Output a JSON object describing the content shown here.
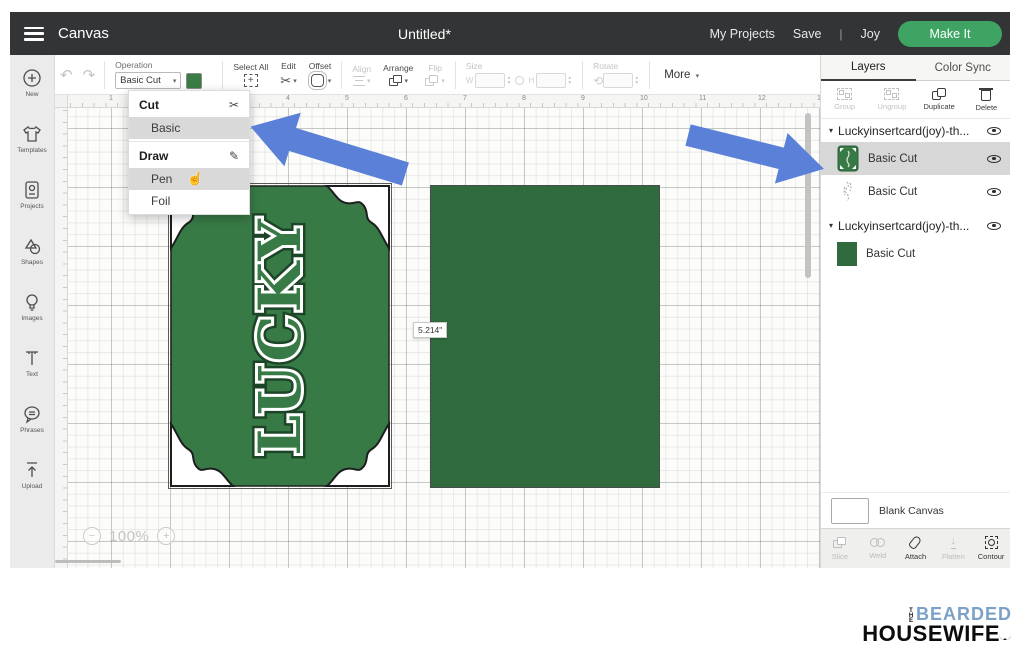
{
  "topbar": {
    "app_title": "Canvas",
    "doc_title": "Untitled*",
    "my_projects": "My Projects",
    "save": "Save",
    "pipe": "|",
    "machine": "Joy",
    "make_it": "Make It"
  },
  "toolbar": {
    "operation_label": "Operation",
    "operation_value": "Basic Cut",
    "select_all": "Select All",
    "edit": "Edit",
    "offset": "Offset",
    "align": "Align",
    "arrange": "Arrange",
    "flip": "Flip",
    "size": "Size",
    "size_w": "W",
    "size_h": "H",
    "rotate": "Rotate",
    "more": "More"
  },
  "dropdown": {
    "cut_header": "Cut",
    "basic": "Basic",
    "draw_header": "Draw",
    "pen": "Pen",
    "foil": "Foil"
  },
  "sidebar": {
    "items": [
      {
        "label": "New"
      },
      {
        "label": "Templates"
      },
      {
        "label": "Projects"
      },
      {
        "label": "Shapes"
      },
      {
        "label": "Images"
      },
      {
        "label": "Text"
      },
      {
        "label": "Phrases"
      },
      {
        "label": "Upload"
      }
    ]
  },
  "rulers": {
    "h": [
      "1",
      "2",
      "3",
      "4",
      "5",
      "6",
      "7",
      "8",
      "9",
      "10",
      "11",
      "12",
      "13"
    ],
    "v": [
      "2",
      "3",
      "4",
      "5",
      "6",
      "7",
      "8",
      "9"
    ]
  },
  "canvas": {
    "card_text": "LUCKY",
    "width_label": "5.214\"",
    "zoom": "100%"
  },
  "layers_panel": {
    "tab_layers": "Layers",
    "tab_color_sync": "Color Sync",
    "group": "Group",
    "ungroup": "Ungroup",
    "duplicate": "Duplicate",
    "delete": "Delete",
    "groups": [
      {
        "name": "Luckyinsertcard(joy)-th...",
        "layers": [
          {
            "label": "Basic Cut"
          },
          {
            "label": "Basic Cut"
          }
        ]
      },
      {
        "name": "Luckyinsertcard(joy)-th...",
        "layers": [
          {
            "label": "Basic Cut"
          }
        ]
      }
    ],
    "blank_canvas": "Blank Canvas",
    "bottom": {
      "slice": "Slice",
      "weld": "Weld",
      "attach": "Attach",
      "flatten": "Flatten",
      "contour": "Contour"
    }
  },
  "icons": {
    "undo": "↶",
    "redo": "↷",
    "scissors": "✂",
    "pencil": "✎",
    "hand": "☝",
    "caret_down": "▾",
    "tri_down": "▾",
    "plus": "+",
    "minus": "−",
    "rotate": "⟲",
    "flatten_arrow": "↓"
  },
  "logo": {
    "the": "THE",
    "line1": "BEARDED",
    "line2": "HOUSEWIFE"
  },
  "colors": {
    "topbar_bg": "#333436",
    "make_it_green": "#3fa463",
    "card_green": "#387a46",
    "rect_green": "#2f6b3d",
    "swatch_green": "#3a7d44",
    "arrow_blue": "#5b80d8",
    "selected_row_gray": "#d7d7d7",
    "logo_blue": "#7ba1c9"
  }
}
